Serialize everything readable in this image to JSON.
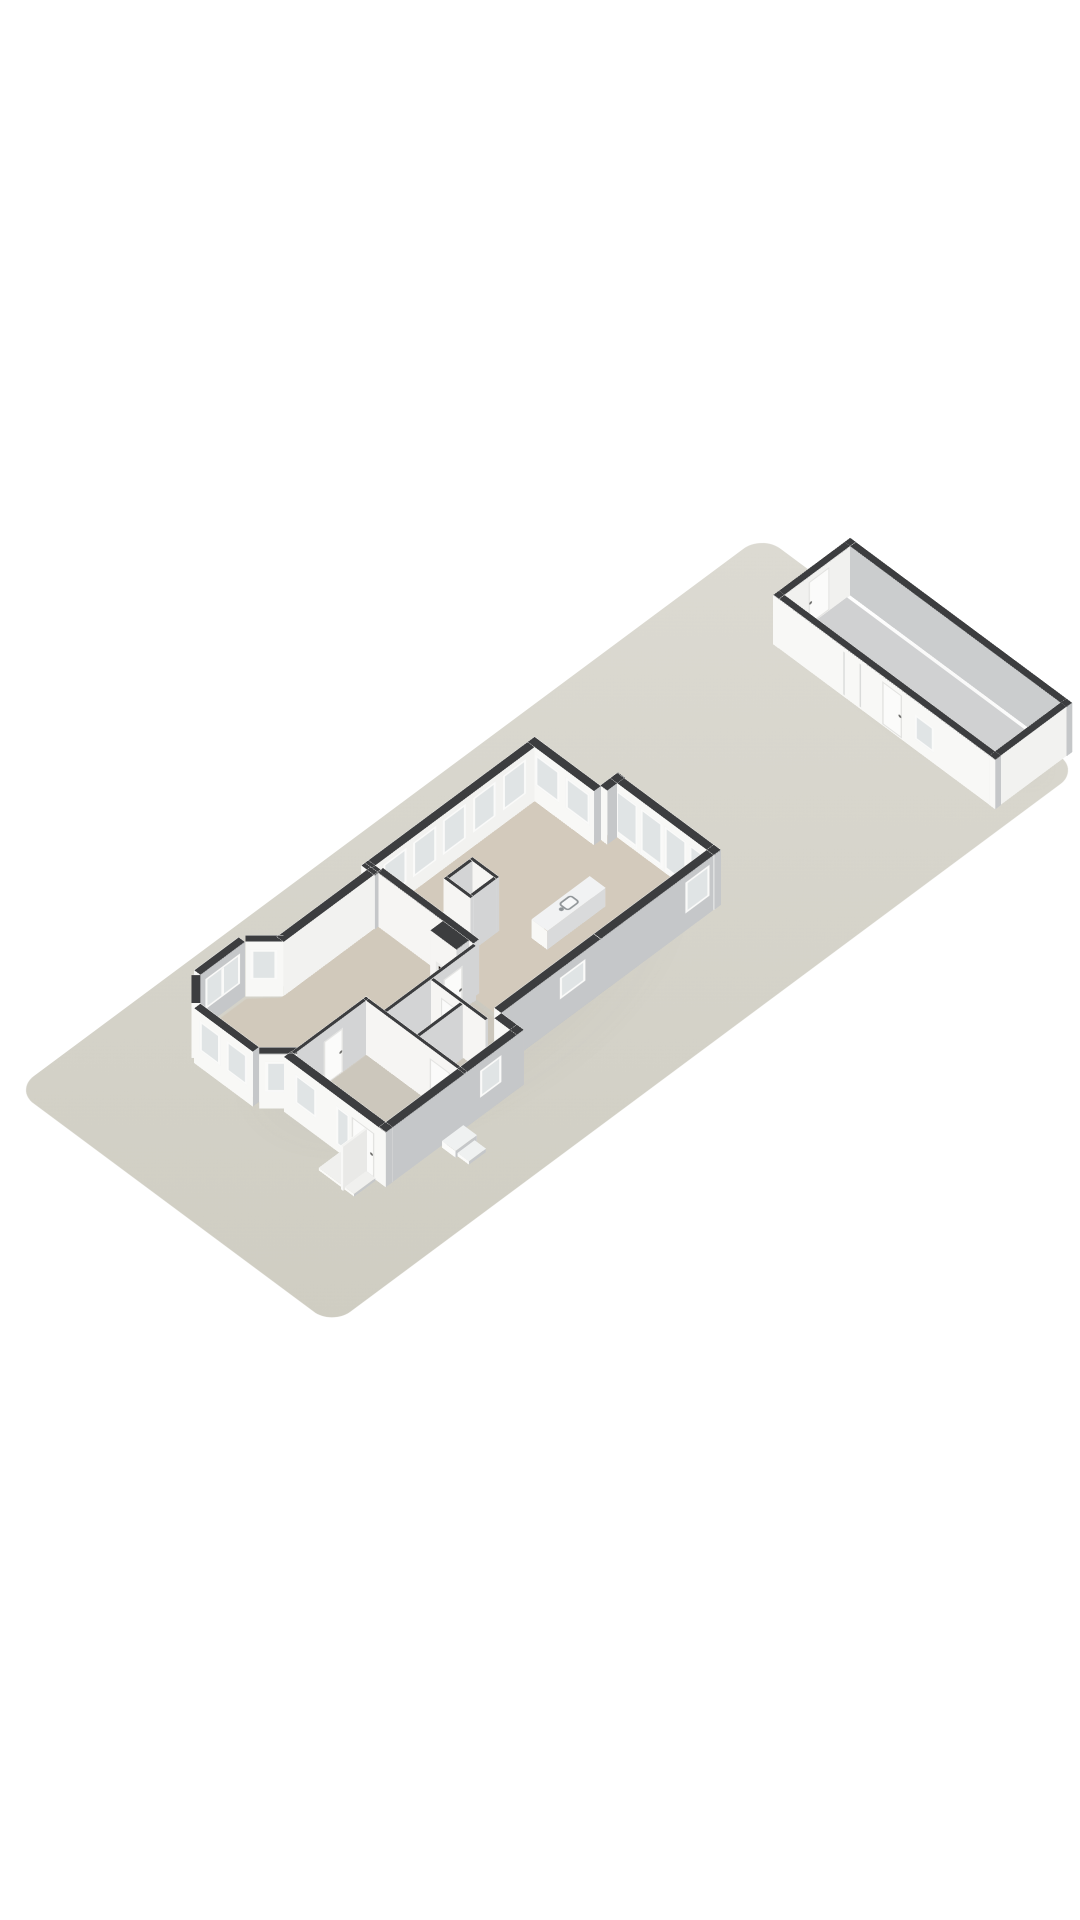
{
  "meta": {
    "description": "3D axonometric floor-plan render of a ground floor house on a long garden plot with a detached garage",
    "view": "isometric-3d-floorplan",
    "visible_text": "none"
  },
  "colors": {
    "background": "#ffffff",
    "wall_cap": "#3c3d3f",
    "ext_face_sw": "#f8f8f6",
    "ext_face_se": "#c5c7c9",
    "ext_face_nw": "#ececea",
    "ext_face_ne": "#f1f1ef",
    "int_face_se": "#d3d4d5",
    "int_face_sw": "#f6f5f3",
    "int_face_nw": "#eeedeb",
    "int_face_ne": "#f0efed",
    "glass": "#e0e4e5",
    "frame": "#fafaf9",
    "door_panel": "#fbfbfa",
    "plot_light": "#dcdad2",
    "plot_dark": "#cfcdc2",
    "floor_dining": "#d3cabc",
    "floor_living": "#d1c9bb",
    "floor_hall": "#ccc7bc",
    "floor_garage": "#d0d1d2",
    "firebox_dark": "#1f1713",
    "firebox_glow": "#a8521f",
    "shadow_tint": "rgba(110,108,100,0.10)"
  },
  "projection": {
    "origin_x": 762,
    "origin_y": 535,
    "rotate_x_deg": 42,
    "rotate_z_deg": 45,
    "px_per_meter": 32,
    "wall_height_m": 2.55,
    "garage_wall_height_m": 2.3
  },
  "plot": {
    "width_m": 14,
    "length_m": 33,
    "corner_radius_px": 26
  },
  "groups": {
    "house": {
      "dx": 0.3,
      "dy": 1.0
    },
    "garage": {
      "dx": 0.0,
      "dy": 0.8
    },
    "plot": {
      "dx": 0,
      "dy": 0
    }
  },
  "shadows": [
    {
      "id": "house-shadow",
      "grp": "house",
      "bbox": [
        1.7,
        10.4,
        9.8,
        17.6
      ]
    },
    {
      "id": "garage-shadow",
      "grp": "garage",
      "bbox": [
        3.2,
        -1.6,
        10.6,
        4.0
      ]
    }
  ],
  "floors": [
    {
      "id": "floor-dining-kitchen",
      "grp": "house",
      "color": "#d3cabc",
      "pts": [
        [
          2.6,
          11.5
        ],
        [
          5.25,
          11.5
        ],
        [
          5.25,
          11.2
        ],
        [
          9.5,
          11.2
        ],
        [
          9.5,
          19.15
        ],
        [
          2.6,
          19.15
        ]
      ]
    },
    {
      "id": "floor-living-bay",
      "grp": "house",
      "color": "#d1c9bb",
      "pts": [
        [
          2.85,
          19.15
        ],
        [
          7.1,
          19.15
        ],
        [
          7.1,
          23.1
        ],
        [
          6.44,
          23.1
        ],
        [
          6.44,
          26.4
        ],
        [
          5.35,
          26.9
        ],
        [
          2.95,
          26.9
        ],
        [
          2.12,
          26.05
        ],
        [
          2.12,
          24.2
        ],
        [
          2.85,
          23.42
        ]
      ]
    },
    {
      "id": "floor-hall-entry",
      "grp": "house",
      "color": "#ccc7bc",
      "pts": [
        [
          7.1,
          19.3
        ],
        [
          9.5,
          19.3
        ],
        [
          9.5,
          20.75
        ],
        [
          10.48,
          20.75
        ],
        [
          10.48,
          26.4
        ],
        [
          6.45,
          26.4
        ],
        [
          6.45,
          23.1
        ],
        [
          7.1,
          23.1
        ]
      ]
    },
    {
      "id": "floor-garage",
      "grp": "garage",
      "color": "#d0d1d2",
      "pts": [
        [
          3.75,
          -0.95
        ],
        [
          13.05,
          -0.95
        ],
        [
          13.05,
          1.95
        ],
        [
          3.75,
          1.95
        ]
      ]
    }
  ],
  "walls": [
    {
      "id": "ne-wall-left",
      "grp": "house",
      "geo": [
        2.3,
        11.65,
        2.95,
        0,
        0.3,
        2.55
      ],
      "wA": [
        [
          0.35,
          0.8,
          1.05,
          1.45,
          "w"
        ],
        [
          1.7,
          0.8,
          1.05,
          1.45,
          "w"
        ]
      ]
    },
    {
      "id": "bump-west-return",
      "grp": "house",
      "geo": [
        5.2,
        11.65,
        0.78,
        270,
        0.3,
        2.55
      ]
    },
    {
      "id": "bump-north-glazed",
      "grp": "house",
      "geo": [
        5.2,
        10.9,
        4.58,
        0,
        0.3,
        2.55
      ],
      "wA": [
        [
          0.25,
          0.12,
          0.98,
          2.1,
          "g"
        ],
        [
          1.33,
          0.12,
          0.98,
          2.1,
          "g"
        ],
        [
          2.41,
          0.12,
          0.98,
          2.1,
          "g"
        ],
        [
          3.49,
          0.12,
          0.98,
          2.1,
          "g"
        ]
      ]
    },
    {
      "id": "se-wall-upper",
      "grp": "house",
      "geo": [
        9.78,
        10.9,
        5.3,
        90,
        0.3,
        2.55
      ],
      "wB": [
        [
          0.5,
          0.8,
          1.05,
          1.45,
          "w"
        ]
      ]
    },
    {
      "id": "se-wall-kitchen",
      "grp": "house",
      "geo": [
        9.78,
        16.2,
        4.4,
        90,
        0.3,
        2.55
      ],
      "wB": [
        [
          0.7,
          1.15,
          1.1,
          1.0,
          "w"
        ]
      ]
    },
    {
      "id": "se-step-wall",
      "grp": "house",
      "geo": [
        9.78,
        20.6,
        1.0,
        0,
        0.3,
        2.55
      ]
    },
    {
      "id": "se-wall-front",
      "grp": "house",
      "geo": [
        10.78,
        20.6,
        6.1,
        90,
        0.3,
        2.55
      ],
      "wB": [
        [
          1.0,
          0.9,
          0.95,
          1.25,
          "w"
        ]
      ]
    },
    {
      "id": "front-wall",
      "grp": "house",
      "geo": [
        6.28,
        26.4,
        4.5,
        0,
        0.3,
        2.55
      ],
      "wA": [
        [
          0.5,
          0.8,
          0.95,
          1.35,
          "w"
        ],
        [
          2.32,
          0.3,
          0.58,
          1.8,
          "w"
        ],
        [
          3.0,
          0.04,
          1.0,
          2.1,
          "d"
        ]
      ]
    },
    {
      "id": "nw-wall-long",
      "grp": "house",
      "geo": [
        2.3,
        19.15,
        7.2,
        270,
        0.3,
        2.55
      ],
      "fA": "#f2f2f0",
      "wA": [
        [
          0.5,
          0.7,
          1.02,
          1.6,
          "w"
        ],
        [
          1.82,
          0.7,
          1.02,
          1.6,
          "w"
        ],
        [
          3.14,
          0.7,
          1.02,
          1.6,
          "w"
        ],
        [
          4.46,
          0.7,
          1.02,
          1.6,
          "w"
        ],
        [
          5.78,
          0.7,
          1.02,
          1.6,
          "w"
        ]
      ]
    },
    {
      "id": "nw-jog",
      "grp": "house",
      "geo": [
        2.3,
        19.0,
        0.58,
        0,
        0.3,
        2.55
      ]
    },
    {
      "id": "nw-wall-living",
      "grp": "house",
      "geo": [
        2.55,
        23.3,
        4.15,
        270,
        0.3,
        2.55
      ],
      "fA": "#f2f2f0"
    },
    {
      "id": "bay-cant-n",
      "grp": "house",
      "geo": [
        2.85,
        23.3,
        1.2,
        135,
        0.28,
        2.55
      ],
      "wB": [
        [
          0.18,
          0.78,
          0.85,
          1.42,
          "w"
        ]
      ]
    },
    {
      "id": "bay-west",
      "grp": "house",
      "geo": [
        2.0,
        24.15,
        1.97,
        90,
        0.28,
        2.55
      ],
      "wB": [
        [
          0.21,
          0.78,
          1.55,
          1.42,
          "w"
        ]
      ]
    },
    {
      "id": "bay-cant-s",
      "grp": "house",
      "geo": [
        2.0,
        26.12,
        1.2,
        45,
        0.28,
        2.55
      ],
      "wB": [
        [
          0.18,
          0.78,
          0.85,
          1.42,
          "w"
        ]
      ]
    },
    {
      "id": "bay-front",
      "grp": "house",
      "geo": [
        2.85,
        26.97,
        2.6,
        0,
        0.28,
        2.55
      ],
      "wA": [
        [
          0.25,
          0.78,
          0.92,
          1.42,
          "w"
        ],
        [
          1.43,
          0.78,
          0.92,
          1.42,
          "w"
        ]
      ],
      "wB": [
        [
          0.25,
          0.78,
          0.92,
          1.42,
          "w"
        ],
        [
          1.43,
          0.78,
          0.92,
          1.42,
          "w"
        ]
      ]
    },
    {
      "id": "bay-cant-e",
      "grp": "house",
      "geo": [
        5.45,
        26.97,
        1.2,
        315,
        0.28,
        2.55
      ],
      "wA": [
        [
          0.18,
          0.78,
          0.85,
          1.42,
          "w"
        ]
      ]
    },
    {
      "id": "living-north-int",
      "grp": "house",
      "geo": [
        2.85,
        18.9,
        4.25,
        0,
        0.25,
        2.55
      ],
      "int": true
    },
    {
      "id": "chimney-breast",
      "grp": "house",
      "geo": [
        5.75,
        19.15,
        1.15,
        0,
        0.55,
        2.55
      ],
      "int": true,
      "wA": [
        [
          0.24,
          0.3,
          0.68,
          1.0,
          "f"
        ]
      ]
    },
    {
      "id": "hall-west-int",
      "grp": "house",
      "geo": [
        7.1,
        23.1,
        3.95,
        270,
        0.14,
        2.55
      ],
      "int": true,
      "wA": [
        [
          2.5,
          0.04,
          0.85,
          2.05,
          "d"
        ]
      ]
    },
    {
      "id": "hall-mid-int",
      "grp": "house",
      "geo": [
        7.24,
        21.05,
        2.42,
        0,
        0.14,
        2.55
      ],
      "int": true,
      "wA": [
        [
          0.45,
          0.04,
          0.85,
          2.05,
          "d"
        ]
      ]
    },
    {
      "id": "bath-div-int",
      "grp": "house",
      "geo": [
        8.55,
        23.1,
        1.91,
        270,
        0.14,
        2.55
      ],
      "int": true
    },
    {
      "id": "hall-south-int",
      "grp": "house",
      "geo": [
        6.3,
        23.1,
        4.48,
        0,
        0.14,
        2.55
      ],
      "int": true,
      "wA": [
        [
          2.95,
          0.04,
          0.9,
          2.05,
          "d"
        ]
      ]
    },
    {
      "id": "entry-west-int",
      "grp": "house",
      "geo": [
        6.3,
        26.4,
        3.3,
        270,
        0.14,
        2.55
      ],
      "int": true,
      "wA": [
        [
          1.3,
          0.04,
          0.85,
          2.05,
          "d"
        ]
      ]
    },
    {
      "id": "closet-n",
      "grp": "house",
      "geo": [
        4.5,
        16.6,
        1.18,
        0,
        0.12,
        2.55
      ],
      "int": true
    },
    {
      "id": "closet-s",
      "grp": "house",
      "geo": [
        4.5,
        17.75,
        1.18,
        0,
        0.12,
        2.55
      ],
      "int": true
    },
    {
      "id": "closet-w",
      "grp": "house",
      "geo": [
        4.5,
        17.75,
        1.03,
        270,
        0.12,
        2.55
      ],
      "int": true
    },
    {
      "id": "closet-e",
      "grp": "house",
      "geo": [
        5.56,
        17.75,
        1.03,
        270,
        0.12,
        2.55
      ],
      "int": true
    },
    {
      "id": "front-door-leaf",
      "grp": "house",
      "geo": [
        9.95,
        26.7,
        1.05,
        90,
        0.08,
        2.05
      ],
      "cap": "#f3f3f1",
      "fA": "#fdfdfc",
      "fB": "#e9e9e7"
    },
    {
      "id": "porch-slab",
      "grp": "house",
      "geo": [
        8.8,
        26.75,
        1.55,
        0,
        0.95,
        0.13
      ],
      "cap": "#f0f0ee",
      "fA": "#fafaf8",
      "fB": "#fafaf8"
    },
    {
      "id": "outside-step-1",
      "grp": "house",
      "geo": [
        10.85,
        23.35,
        0.6,
        0,
        0.95,
        0.32
      ],
      "cap": "#eff1f1",
      "fA": "#fbfbfa"
    },
    {
      "id": "outside-step-2",
      "grp": "house",
      "geo": [
        11.45,
        23.45,
        0.5,
        0,
        0.75,
        0.16
      ],
      "cap": "#eff1f1",
      "fA": "#fbfbfa"
    },
    {
      "id": "kitchen-island",
      "grp": "house",
      "geo": [
        6.62,
        16.1,
        2.55,
        270,
        0.7,
        0.92
      ],
      "cap": "#f1f2f3",
      "fA": "#d9dadb",
      "sink": true
    },
    {
      "id": "garage-end-nw",
      "grp": "garage",
      "geo": [
        3.75,
        -1.2,
        3.4,
        90,
        0.25,
        2.3
      ],
      "fB": "#f1f1ef",
      "wB": [
        [
          1.15,
          0.06,
          0.95,
          2.0,
          "d"
        ]
      ]
    },
    {
      "id": "garage-long-ne",
      "grp": "garage",
      "geo": [
        3.5,
        -1.2,
        9.8,
        0,
        0.25,
        2.3
      ],
      "fA": "#cbcdce"
    },
    {
      "id": "garage-long-se",
      "grp": "garage",
      "geo": [
        3.5,
        1.95,
        9.8,
        0,
        0.25,
        2.3
      ],
      "wA": [
        [
          3.1,
          0.1,
          0.07,
          2.0,
          "s"
        ],
        [
          3.8,
          0.1,
          0.07,
          2.0,
          "s"
        ],
        [
          4.8,
          0.06,
          0.9,
          2.0,
          "d"
        ],
        [
          6.25,
          0.5,
          0.85,
          1.15,
          "w"
        ]
      ]
    },
    {
      "id": "garage-end-e",
      "grp": "garage",
      "geo": [
        13.3,
        -1.2,
        3.4,
        90,
        0.25,
        2.3
      ],
      "fB": "#f2f2f0"
    }
  ],
  "objects": {
    "plot": {
      "name": "garden-plot"
    },
    "house": {
      "name": "ground-floor-house",
      "rooms": [
        "dining-room",
        "kitchen",
        "living-room-with-bay-window",
        "hallway",
        "bathroom",
        "entrance-hall",
        "closet"
      ],
      "features": [
        "fireplace",
        "kitchen-island-with-sink",
        "glazed-door-row",
        "bay-windows",
        "open-front-door-leaf",
        "porch-slab",
        "outside-steps"
      ]
    },
    "garage": {
      "name": "detached-garage",
      "features": [
        "inner-end-door",
        "side-door",
        "side-window"
      ]
    }
  }
}
